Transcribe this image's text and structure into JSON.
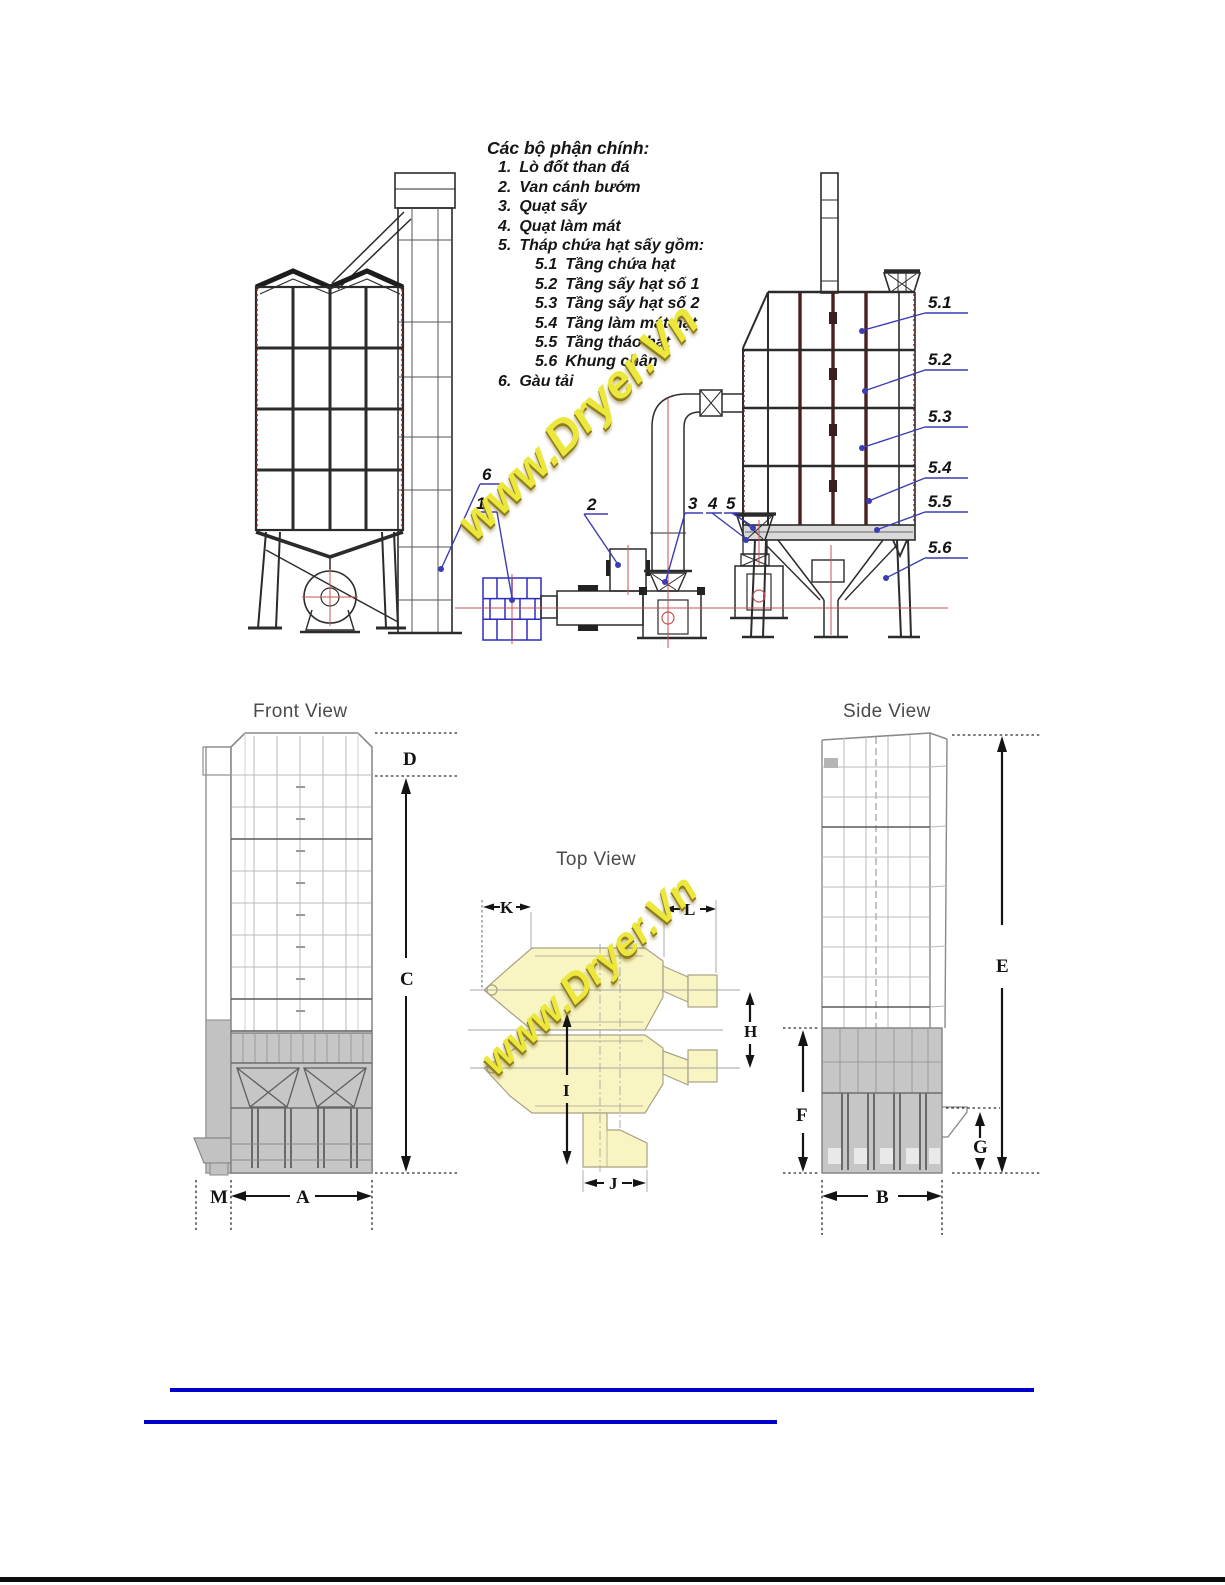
{
  "legend": {
    "title": "Các bộ phận chính:",
    "items": [
      {
        "num": "1.",
        "text": "Lò đốt than đá"
      },
      {
        "num": "2.",
        "text": "Van cánh bướm"
      },
      {
        "num": "3.",
        "text": "Quạt sấy"
      },
      {
        "num": "4.",
        "text": "Quạt làm mát"
      },
      {
        "num": "5.",
        "text": "Tháp chứa hạt sấy gồm:"
      },
      {
        "num": "5.1",
        "text": "Tầng chứa hạt"
      },
      {
        "num": "5.2",
        "text": "Tầng sấy hạt số 1"
      },
      {
        "num": "5.3",
        "text": "Tầng sấy hạt số 2"
      },
      {
        "num": "5.4",
        "text": "Tầng làm mát hạt"
      },
      {
        "num": "5.5",
        "text": "Tầng tháo hạt"
      },
      {
        "num": "5.6",
        "text": "Khung chân"
      },
      {
        "num": "6.",
        "text": "Gàu tải"
      }
    ]
  },
  "callouts": {
    "c1": "1",
    "c2": "2",
    "c3": "3",
    "c4": "4",
    "c5": "5",
    "c6": "6",
    "c51": "5.1",
    "c52": "5.2",
    "c53": "5.3",
    "c54": "5.4",
    "c55": "5.5",
    "c56": "5.6"
  },
  "views": {
    "front_title": "Front View",
    "top_title": "Top View",
    "side_title": "Side View"
  },
  "dims": {
    "A": "A",
    "B": "B",
    "C": "C",
    "D": "D",
    "E": "E",
    "F": "F",
    "G": "G",
    "H": "H",
    "I": "I",
    "J": "J",
    "K": "K",
    "L": "L",
    "M": "M"
  },
  "watermark": {
    "text": "www.Dryer.Vn",
    "fill": "#ece73c",
    "shadow": "#8f7d1c"
  },
  "footer": {
    "link_lines": 2,
    "link_color": "#0101cd"
  },
  "colors": {
    "leader_blue": "#3c3cb4",
    "furnace_blue": "#2b2bc0",
    "centerline_red": "#c85050",
    "maroon": "#6e2222",
    "plan_fill": "#f9f5c3",
    "drawing_gray": "#9a9a9a",
    "dim_black": "#141414"
  }
}
